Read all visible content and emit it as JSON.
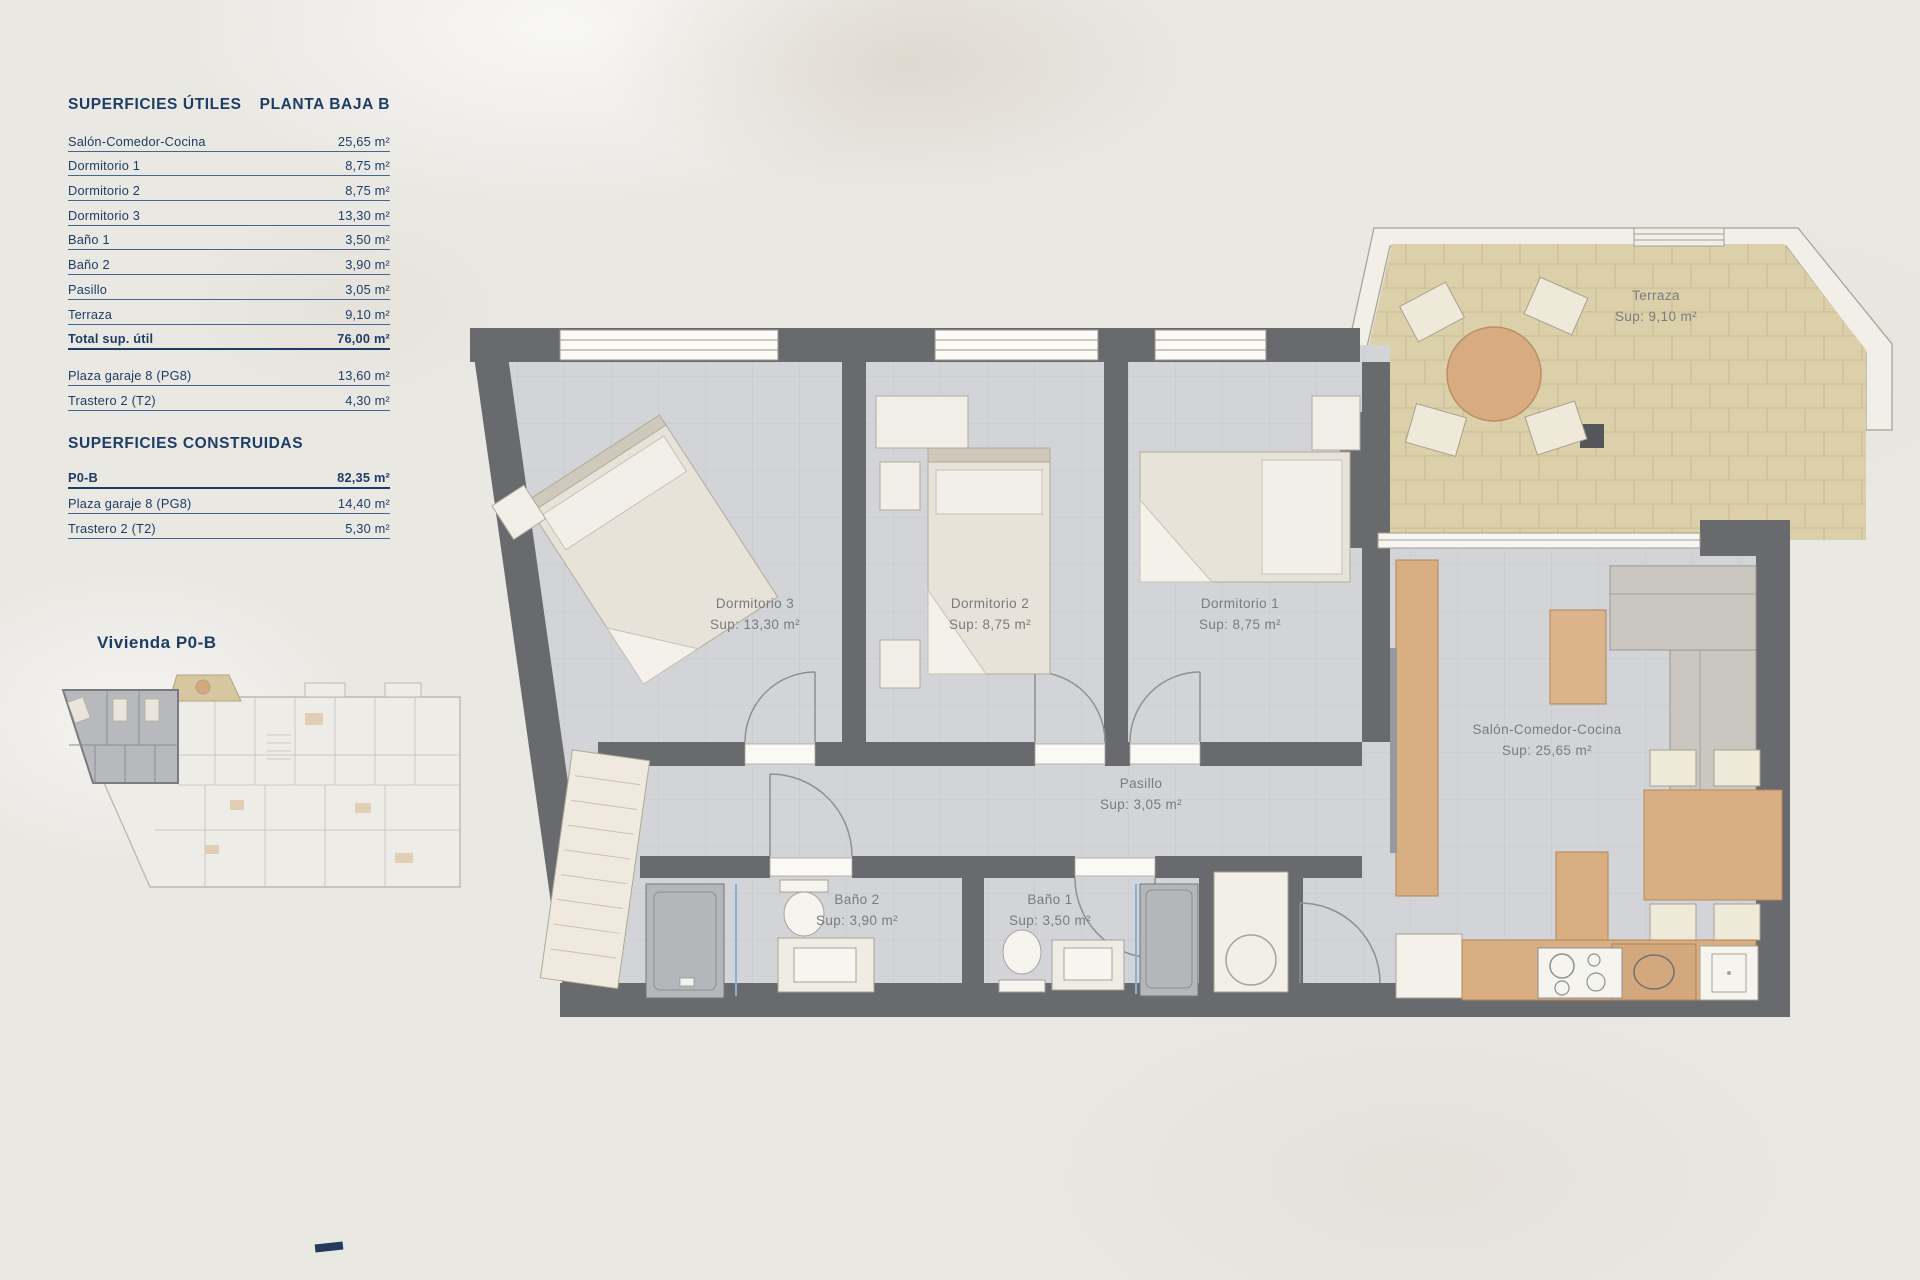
{
  "panel": {
    "title_left": "SUPERFICIES ÚTILES",
    "title_right": "PLANTA BAJA B",
    "useful_rows": [
      {
        "label": "Salón-Comedor-Cocina",
        "value": "25,65 m²"
      },
      {
        "label": "Dormitorio 1",
        "value": "8,75 m²"
      },
      {
        "label": "Dormitorio 2",
        "value": "8,75 m²"
      },
      {
        "label": "Dormitorio 3",
        "value": "13,30 m²"
      },
      {
        "label": "Baño 1",
        "value": "3,50 m²"
      },
      {
        "label": "Baño 2",
        "value": "3,90 m²"
      },
      {
        "label": "Pasillo",
        "value": "3,05 m²"
      },
      {
        "label": "Terraza",
        "value": "9,10 m²"
      }
    ],
    "total_row": {
      "label": "Total sup. útil",
      "value": "76,00 m²"
    },
    "annex_rows": [
      {
        "label": "Plaza garaje 8 (PG8)",
        "value": "13,60 m²"
      },
      {
        "label": "Trastero 2 (T2)",
        "value": "4,30 m²"
      }
    ],
    "built_title": "SUPERFICIES CONSTRUIDAS",
    "built_rows": [
      {
        "label": "P0-B",
        "value": "82,35 m²"
      },
      {
        "label": "Plaza garaje 8 (PG8)",
        "value": "14,40 m²"
      },
      {
        "label": "Trastero 2 (T2)",
        "value": "5,30 m²"
      }
    ],
    "overview_label": "Vivienda P0-B"
  },
  "plan": {
    "labels": {
      "terraza": {
        "name": "Terraza",
        "sup": "Sup: 9,10 m²"
      },
      "dormitorio3": {
        "name": "Dormitorio 3",
        "sup": "Sup: 13,30 m²"
      },
      "dormitorio2": {
        "name": "Dormitorio 2",
        "sup": "Sup: 8,75 m²"
      },
      "dormitorio1": {
        "name": "Dormitorio 1",
        "sup": "Sup: 8,75 m²"
      },
      "salon": {
        "name": "Salón-Comedor-Cocina",
        "sup": "Sup: 25,65 m²"
      },
      "pasillo": {
        "name": "Pasillo",
        "sup": "Sup: 3,05 m²"
      },
      "bano2": {
        "name": "Baño 2",
        "sup": "Sup: 3,90 m²"
      },
      "bano1": {
        "name": "Baño 1",
        "sup": "Sup: 3,50 m²"
      }
    },
    "colors": {
      "accent_navy": "#1e3d66",
      "wall": "#696a6d",
      "floor": "#d2d4d7",
      "terrace": "#dcd0ab",
      "wood": "#d9ae83"
    }
  }
}
